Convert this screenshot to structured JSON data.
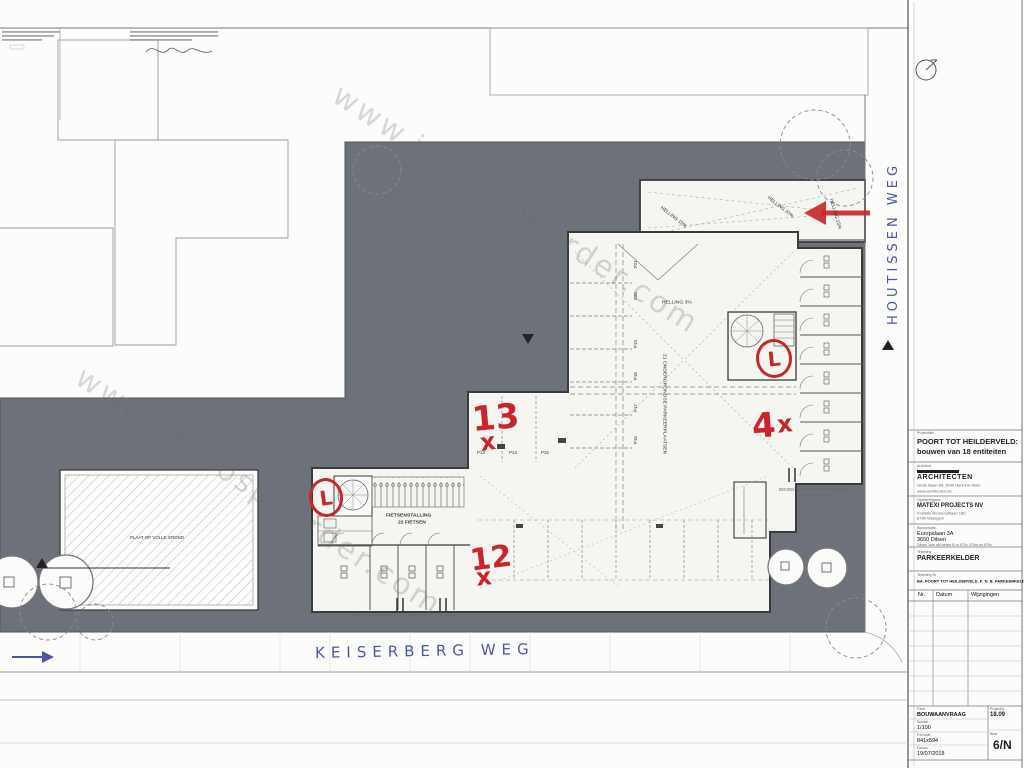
{
  "watermark": "www.immospeurder.com",
  "streets": {
    "bottom": "KEISERBERG WEG",
    "right": "HOUTISSEN WEG"
  },
  "red_marks": {
    "n13": "13",
    "n12": "12",
    "n4": "4",
    "x": "x",
    "l": "L"
  },
  "plan": {
    "helling15": "HELLING 15%",
    "helling20": "HELLING 20%",
    "helling3": "HELLING 3%",
    "parking21": "21 ONDERGRONDSE PARKEERPLAATSEN",
    "fiets1": "FIETSENSTALLING",
    "fiets2": "22 FIETSEN",
    "slab": "PLAAT OP VOLLE GROND",
    "vent_long": "BOVEN- EN ONDERVERLUCHTING VIA KELDERWAND",
    "vent_r1": "BOVEN- EN ONDERVERLUCHTING",
    "vent_r2": "VIA KELDERWAND",
    "p_row": [
      "P13",
      "P14",
      "P15"
    ],
    "p_col": [
      "P16",
      "P17",
      "P18",
      "P19",
      "P20",
      "P21"
    ]
  },
  "title_block": {
    "project_label": "Projecttitel",
    "project1": "POORT TOT HEILDERVELD:",
    "project2": "bouwen van 18 entiteiten",
    "architect_label": "Architect",
    "architect_name": "ARCHITECTEN",
    "architect_addr": "Grote Baan 84, 3540 Herk-De-Stad",
    "architect_web": "www.architecten.be",
    "client_label": "Opdrachtgever",
    "client_name": "MATEXI PROJECTS NV",
    "client_addr1": "Franklin Rooseveltlaan 180",
    "client_addr2": "8790 Waregem",
    "site_label": "Bouwplaats",
    "site1": "Europalaan 3A",
    "site2": "3650 Dilsen",
    "site3": "Dilsen 1ste afd sectie B nr 579v, 579w en 579x",
    "drawing_label": "Tekening",
    "drawing_name": "PARKEERKELDER",
    "file_label": "Tekening Nr",
    "file_name": "BA_POORT TOT HEILDERVELD_P_N_B_PARKEERKELDER",
    "rev_headers": [
      "Nr.",
      "Datum",
      "Wijzigingen"
    ],
    "phase_label": "Fase",
    "phase": "BOUWAANVRAAG",
    "scale_label": "Schaal",
    "scale": "1/100",
    "format_label": "Formaat",
    "format": "841x594",
    "date_label": "Datum",
    "date": "19/07/2018",
    "projno_label": "Projectnr",
    "projno": "18.09",
    "sheet_label": "Blad",
    "sheet": "6/N"
  }
}
